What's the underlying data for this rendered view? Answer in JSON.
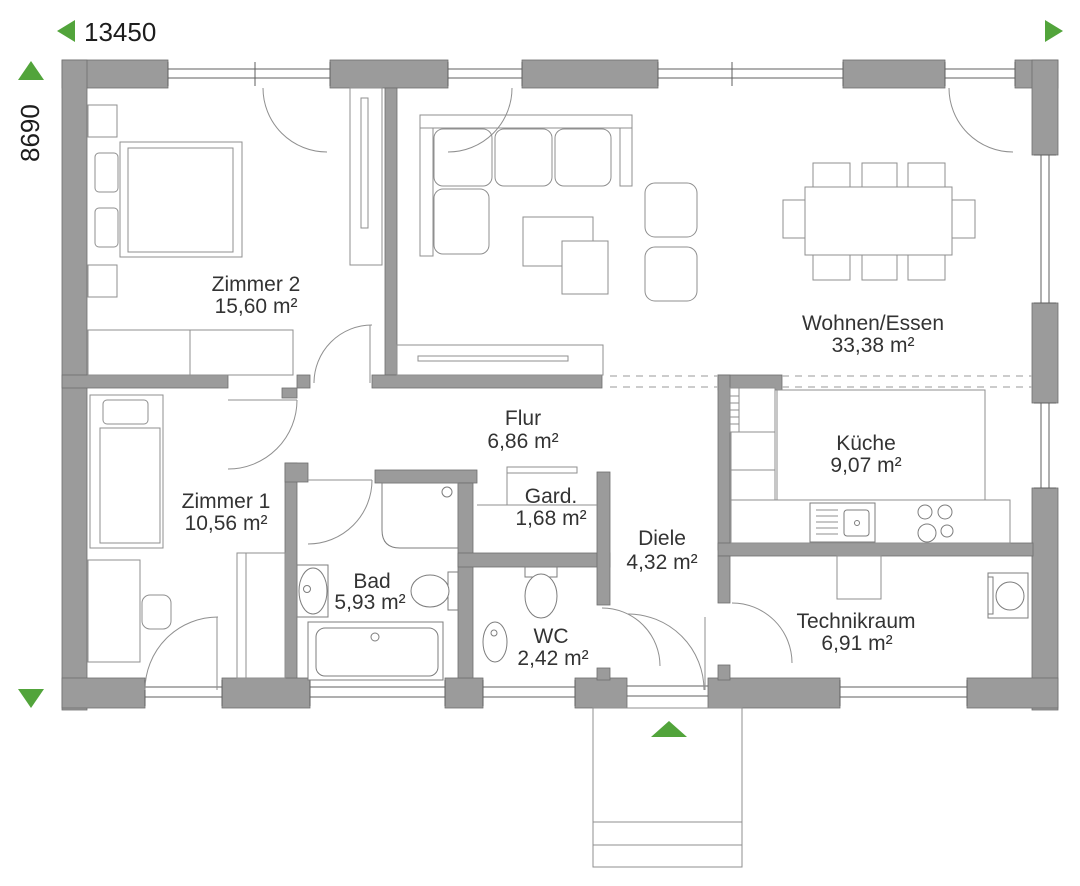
{
  "plan": {
    "dimension_width": "13450",
    "dimension_height": "8690",
    "rooms": [
      {
        "name": "Zimmer 2",
        "area": "15,60 m²"
      },
      {
        "name": "Zimmer 1",
        "area": "10,56 m²"
      },
      {
        "name": "Wohnen/Essen",
        "area": "33,38 m²"
      },
      {
        "name": "Flur",
        "area": "6,86 m²"
      },
      {
        "name": "Gard.",
        "area": "1,68 m²"
      },
      {
        "name": "Küche",
        "area": "9,07 m²"
      },
      {
        "name": "Bad",
        "area": "5,93 m²"
      },
      {
        "name": "WC",
        "area": "2,42 m²"
      },
      {
        "name": "Diele",
        "area": "4,32 m²"
      },
      {
        "name": "Technikraum",
        "area": "6,91 m²"
      }
    ],
    "colors": {
      "wall": "#9b9b9b",
      "accent_green": "#52a43b",
      "furniture_line": "#8f8f8f",
      "text": "#333333"
    },
    "icons": {
      "dim_arrow_left": "left-triangle",
      "dim_arrow_right": "right-triangle",
      "dim_arrow_up": "up-triangle",
      "dim_arrow_down": "down-triangle",
      "entrance_arrow": "up-triangle"
    }
  }
}
